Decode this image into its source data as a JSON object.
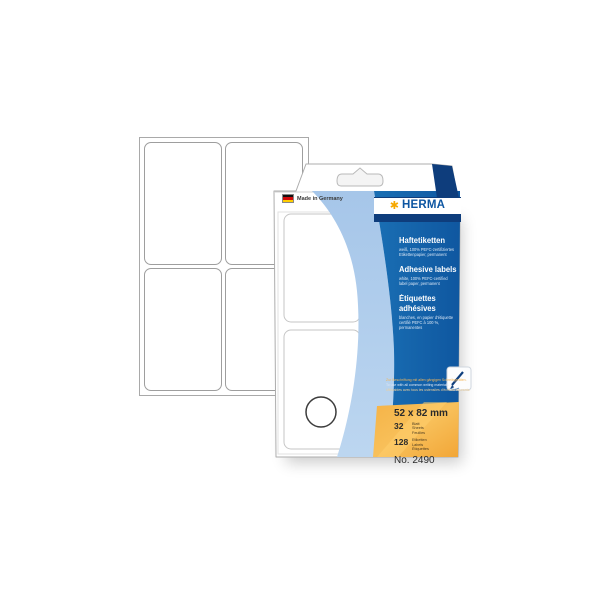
{
  "package": {
    "made_in": "Made in Germany",
    "brand": "HERMA",
    "brand_asterisk": "✱",
    "languages": [
      {
        "title": "Haftetiketten",
        "subtitle": "weiß, 100% PEFC-zertifiziertes\nEtikettenpapier, permanent"
      },
      {
        "title": "Adhesive labels",
        "subtitle": "white, 100% PEFC-certified\nlabel paper, permanent"
      },
      {
        "title": "Étiquettes\nadhésives",
        "subtitle": "blanches, en papier d'étiquette\ncertifié PEFC à 100 %,\npermanentes"
      }
    ],
    "usage_note": {
      "de": "Zur Beschriftung mit allen gängigen Schreibgeräten.",
      "en": "To use with all common writing materials.",
      "fr": "Utilisables avec tous les ustensiles d'écriture courants."
    },
    "specs": {
      "size": "52 x 82 mm",
      "sheets_count": "32",
      "sheets_units": "Blatt\nSheets\nFeuilles",
      "labels_count": "128",
      "labels_units": "Etiketten\nLabels\nÉtiquettes",
      "item_number": "No. 2490"
    },
    "icons": {
      "writing_tools": "writing-tools-icon",
      "german_flag": "german-flag-icon",
      "euro_slot": "euro-hang-slot",
      "punch_hole": "punch-hole-circle"
    },
    "colors": {
      "panel_blue": "#1467ad",
      "navy": "#0e3d7c",
      "light_blue": "#abc9ea",
      "accent_orange": "#f3ab3d",
      "logo_gold": "#f6a800",
      "logo_blue": "#0d56a2"
    }
  }
}
